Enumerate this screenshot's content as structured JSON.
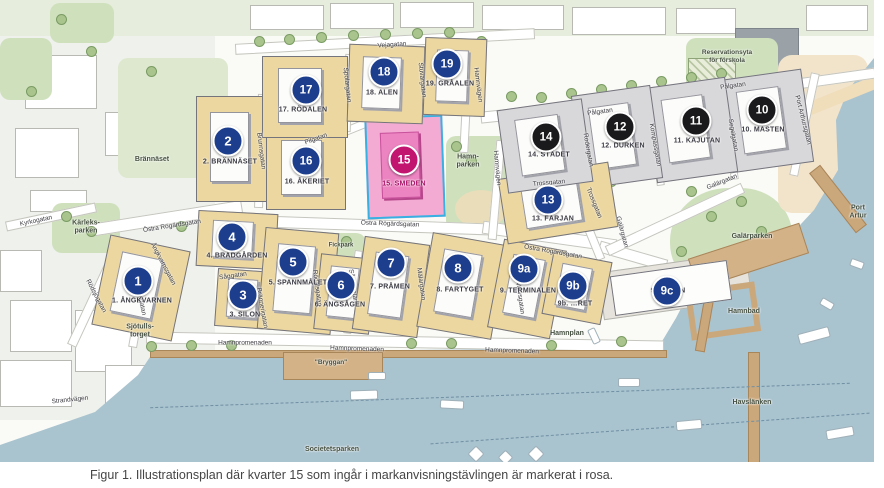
{
  "figure": {
    "caption": "Figur 1. Illustrationsplan där kvarter 15 som ingår i markanvisningstävlingen är markerat i rosa."
  },
  "colors": {
    "marker_blue": "#1d3e8c",
    "marker_black": "#1a1a1c",
    "marker_pink": "#c2156f",
    "block_tan": "#ecd7a0",
    "block_gray": "#d8d8db",
    "block_pink": "#f3abd4",
    "pink_outline": "#38b1e2",
    "water": "#a9c3cf"
  },
  "map": {
    "blocks": [
      {
        "id": "1",
        "num": "1",
        "label": "1. ÅNGKVARNEN",
        "marker": "blue",
        "style": "tan",
        "rect": [
          100,
          242,
          82,
          92,
          12
        ],
        "circle": [
          138,
          281
        ],
        "lpos": [
          142,
          301
        ]
      },
      {
        "id": "2",
        "num": "2",
        "label": "2. BRÄNNÄSET",
        "marker": "blue",
        "style": "tan",
        "rect": [
          196,
          96,
          76,
          106,
          0
        ],
        "circle": [
          228,
          141
        ],
        "lpos": [
          230,
          162
        ]
      },
      {
        "id": "3",
        "num": "3",
        "label": "3. SILON",
        "marker": "blue",
        "style": "tan",
        "rect": [
          216,
          270,
          58,
          58,
          4
        ],
        "circle": [
          243,
          295
        ],
        "lpos": [
          245,
          315
        ]
      },
      {
        "id": "4",
        "num": "4",
        "label": "4. BRÄDGÅRDEN",
        "marker": "blue",
        "style": "tan",
        "rect": [
          197,
          212,
          80,
          56,
          3
        ],
        "circle": [
          232,
          237
        ],
        "lpos": [
          237,
          256
        ]
      },
      {
        "id": "5",
        "num": "5",
        "label": "5. SPANNMÅLET",
        "marker": "blue",
        "style": "tan",
        "rect": [
          261,
          230,
          74,
          102,
          5
        ],
        "circle": [
          293,
          262
        ],
        "lpos": [
          298,
          283
        ]
      },
      {
        "id": "6",
        "num": "6",
        "label": "6. ÄNGSÅGEN",
        "marker": "blue",
        "style": "tan",
        "rect": [
          317,
          256,
          56,
          76,
          6
        ],
        "circle": [
          341,
          285
        ],
        "lpos": [
          340,
          305
        ]
      },
      {
        "id": "7",
        "num": "7",
        "label": "7. PRÅMEN",
        "marker": "blue",
        "style": "tan",
        "rect": [
          358,
          240,
          66,
          94,
          8
        ],
        "circle": [
          391,
          263
        ],
        "lpos": [
          390,
          287
        ]
      },
      {
        "id": "8",
        "num": "8",
        "label": "8. FARTYGET",
        "marker": "blue",
        "style": "tan",
        "rect": [
          424,
          238,
          76,
          96,
          10
        ],
        "circle": [
          458,
          268
        ],
        "lpos": [
          460,
          290
        ]
      },
      {
        "id": "9a",
        "num": "9a",
        "label": "9. TERMINALEN",
        "marker": "blue",
        "style": "tan",
        "rect": [
          495,
          244,
          64,
          90,
          11
        ],
        "circle": [
          524,
          269
        ],
        "lpos": [
          528,
          291
        ]
      },
      {
        "id": "9b",
        "num": "9b",
        "label": "9b. …RET",
        "marker": "blue",
        "style": "tan",
        "rect": [
          547,
          256,
          60,
          64,
          11
        ],
        "circle": [
          573,
          286
        ],
        "lpos": [
          575,
          304
        ]
      },
      {
        "id": "9c",
        "num": "9c",
        "label": "9c. PIREN",
        "marker": "blue",
        "style": "white",
        "rect": [
          612,
          268,
          118,
          40,
          -8
        ],
        "circle": [
          667,
          291
        ],
        "lpos": [
          668,
          291
        ]
      },
      {
        "id": "10",
        "num": "10",
        "label": "10. MASTEN",
        "marker": "black",
        "style": "gray",
        "rect": [
          724,
          74,
          84,
          94,
          -8
        ],
        "circle": [
          762,
          110
        ],
        "lpos": [
          763,
          130
        ]
      },
      {
        "id": "11",
        "num": "11",
        "label": "11. KAJUTAN",
        "marker": "black",
        "style": "gray",
        "rect": [
          650,
          82,
          82,
          96,
          -8
        ],
        "circle": [
          696,
          121
        ],
        "lpos": [
          697,
          141
        ]
      },
      {
        "id": "12",
        "num": "12",
        "label": "12. DURKEN",
        "marker": "black",
        "style": "gray",
        "rect": [
          577,
          90,
          80,
          94,
          -8
        ],
        "circle": [
          620,
          127
        ],
        "lpos": [
          623,
          146
        ]
      },
      {
        "id": "13",
        "num": "13",
        "label": "13. FÄRJAN",
        "marker": "blue",
        "style": "tan",
        "rect": [
          502,
          170,
          112,
          66,
          -9
        ],
        "circle": [
          548,
          200
        ],
        "lpos": [
          553,
          219
        ]
      },
      {
        "id": "14",
        "num": "14",
        "label": "14. STÄDET",
        "marker": "black",
        "style": "gray",
        "rect": [
          502,
          104,
          86,
          84,
          -8
        ],
        "circle": [
          546,
          137
        ],
        "lpos": [
          549,
          155
        ]
      },
      {
        "id": "15",
        "num": "15",
        "label": "15. SMEDEN",
        "marker": "pink",
        "style": "pink",
        "rect": [
          366,
          116,
          78,
          102,
          -2
        ],
        "circle": [
          404,
          160
        ],
        "lpos": [
          404,
          184
        ]
      },
      {
        "id": "16",
        "num": "16",
        "label": "16. ÅKERIET",
        "marker": "blue",
        "style": "tan",
        "rect": [
          266,
          128,
          80,
          82,
          0
        ],
        "circle": [
          306,
          161
        ],
        "lpos": [
          307,
          182
        ]
      },
      {
        "id": "17",
        "num": "17",
        "label": "17. RÖDALEN",
        "marker": "blue",
        "style": "tan",
        "rect": [
          262,
          56,
          86,
          82,
          0
        ],
        "circle": [
          306,
          90
        ],
        "lpos": [
          303,
          110
        ]
      },
      {
        "id": "18",
        "num": "18",
        "label": "18. ALEN",
        "marker": "blue",
        "style": "tan",
        "rect": [
          348,
          45,
          76,
          78,
          2
        ],
        "circle": [
          384,
          72
        ],
        "lpos": [
          382,
          93
        ]
      },
      {
        "id": "19",
        "num": "19",
        "label": "19. GRÅALEN",
        "marker": "blue",
        "style": "tan",
        "rect": [
          424,
          38,
          62,
          78,
          2
        ],
        "circle": [
          447,
          64
        ],
        "lpos": [
          450,
          84
        ]
      }
    ],
    "streets": [
      {
        "t": "Vejagatan",
        "x": 392,
        "y": 45,
        "r": -4
      },
      {
        "t": "Pilgatan",
        "x": 316,
        "y": 139,
        "r": -20
      },
      {
        "t": "Pålgatan",
        "x": 600,
        "y": 112,
        "r": -8
      },
      {
        "t": "Pålgatan",
        "x": 733,
        "y": 86,
        "r": -8
      },
      {
        "t": "Trossgatan",
        "x": 549,
        "y": 183,
        "r": -5
      },
      {
        "t": "Trossgatan",
        "x": 594,
        "y": 203,
        "r": 68
      },
      {
        "t": "Galärgatan",
        "x": 722,
        "y": 182,
        "r": -22
      },
      {
        "t": "Galärgatan",
        "x": 622,
        "y": 232,
        "r": 75
      },
      {
        "t": "Hamnvägen",
        "x": 478,
        "y": 85,
        "r": 83
      },
      {
        "t": "Hamnvägen",
        "x": 497,
        "y": 168,
        "r": 85
      },
      {
        "t": "Brunnsgatan",
        "x": 261,
        "y": 151,
        "r": 83
      },
      {
        "t": "Östra Rögärdsgatan",
        "x": 172,
        "y": 226,
        "r": -9
      },
      {
        "t": "Östra Rögärdsgatan",
        "x": 390,
        "y": 224,
        "r": 2
      },
      {
        "t": "Östra Rögärdsgatan",
        "x": 553,
        "y": 252,
        "r": 10
      },
      {
        "t": "Hamnpromenaden",
        "x": 245,
        "y": 343,
        "r": 0
      },
      {
        "t": "Hamnpromenaden",
        "x": 357,
        "y": 349,
        "r": 2
      },
      {
        "t": "Hamnpromenaden",
        "x": 512,
        "y": 351,
        "r": 2
      },
      {
        "t": "Kyrkogatan",
        "x": 36,
        "y": 221,
        "r": -12
      },
      {
        "t": "Rödsjögatan",
        "x": 96,
        "y": 296,
        "r": 62
      },
      {
        "t": "Sjötullsgatan",
        "x": 140,
        "y": 297,
        "r": 78
      },
      {
        "t": "Ångkvarnsgatan",
        "x": 163,
        "y": 264,
        "r": 62
      },
      {
        "t": "Såggatan",
        "x": 233,
        "y": 276,
        "r": -8
      },
      {
        "t": "Brännerigatan",
        "x": 262,
        "y": 308,
        "r": 80
      },
      {
        "t": "Rödalsgatan",
        "x": 317,
        "y": 288,
        "r": 82
      },
      {
        "t": "Sågargatan",
        "x": 353,
        "y": 286,
        "r": 82
      },
      {
        "t": "Mälargatan",
        "x": 421,
        "y": 284,
        "r": 82
      },
      {
        "t": "Varvsgatan",
        "x": 520,
        "y": 298,
        "r": 82
      },
      {
        "t": "Spolargatan",
        "x": 347,
        "y": 85,
        "r": 84
      },
      {
        "t": "Stuvargatan",
        "x": 422,
        "y": 80,
        "r": 84
      },
      {
        "t": "Rodergatan",
        "x": 588,
        "y": 150,
        "r": 80
      },
      {
        "t": "Kompassgatan",
        "x": 655,
        "y": 145,
        "r": 80
      },
      {
        "t": "Segelgatan",
        "x": 733,
        "y": 135,
        "r": 80
      },
      {
        "t": "Port Arthursgatan",
        "x": 803,
        "y": 120,
        "r": 76
      },
      {
        "t": "Strandvägen",
        "x": 70,
        "y": 400,
        "r": -6
      }
    ],
    "areas": [
      {
        "t": "Brännäset",
        "x": 152,
        "y": 160
      },
      {
        "t": "Kärleks-\nparken",
        "x": 86,
        "y": 228
      },
      {
        "t": "Hamn-\nparken",
        "x": 468,
        "y": 162
      },
      {
        "t": "Fickpark",
        "x": 341,
        "y": 246,
        "s": 6
      },
      {
        "t": "Reservationsyta\nför förskola",
        "x": 727,
        "y": 57,
        "s": 6.5
      },
      {
        "t": "Galärparken",
        "x": 752,
        "y": 237
      },
      {
        "t": "Port Artur",
        "x": 858,
        "y": 213
      },
      {
        "t": "Hamnbad",
        "x": 744,
        "y": 312
      },
      {
        "t": "Havslänken",
        "x": 752,
        "y": 403
      },
      {
        "t": "Societetsparken",
        "x": 332,
        "y": 450
      },
      {
        "t": "Sjötulls-\ntorget",
        "x": 140,
        "y": 332
      },
      {
        "t": "Hamnplan",
        "x": 567,
        "y": 334
      },
      {
        "t": "\"Bryggan\"",
        "x": 331,
        "y": 363,
        "s": 6.5
      }
    ]
  }
}
